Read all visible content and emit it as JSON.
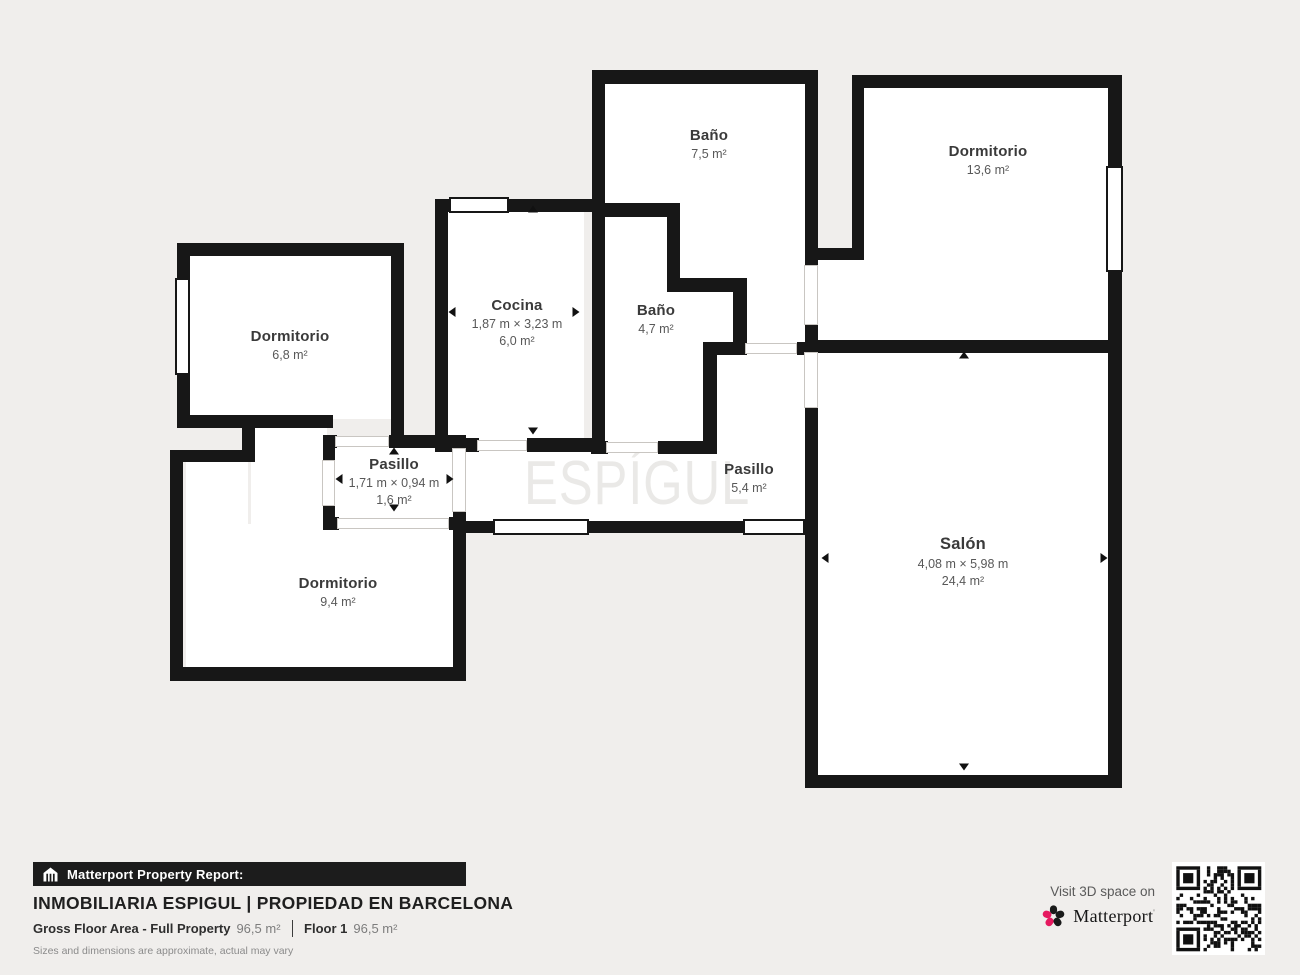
{
  "watermark": {
    "text": "ESPÍGUL"
  },
  "plan": {
    "wall_color": "#171717",
    "floor_color": "#ffffff",
    "background": "#f0eeec",
    "fills": [
      [
        598,
        78,
        210,
        130
      ],
      [
        676,
        180,
        132,
        104
      ],
      [
        743,
        270,
        65,
        78
      ],
      [
        860,
        84,
        252,
        260
      ],
      [
        816,
        256,
        80,
        88
      ],
      [
        444,
        208,
        140,
        234
      ],
      [
        601,
        213,
        70,
        232
      ],
      [
        601,
        288,
        136,
        60
      ],
      [
        601,
        348,
        106,
        97
      ],
      [
        713,
        350,
        96,
        100
      ],
      [
        463,
        447,
        345,
        78
      ],
      [
        331,
        442,
        127,
        80
      ],
      [
        186,
        252,
        209,
        167
      ],
      [
        186,
        458,
        62,
        212
      ],
      [
        251,
        424,
        76,
        246
      ],
      [
        186,
        524,
        272,
        146
      ],
      [
        814,
        348,
        298,
        430
      ]
    ],
    "walls": [
      [
        592,
        70,
        226,
        14
      ],
      [
        805,
        70,
        13,
        197
      ],
      [
        805,
        325,
        13,
        28
      ],
      [
        805,
        407,
        13,
        381
      ],
      [
        852,
        75,
        270,
        13
      ],
      [
        852,
        75,
        12,
        185
      ],
      [
        818,
        248,
        46,
        12
      ],
      [
        1108,
        75,
        14,
        91
      ],
      [
        1108,
        272,
        14,
        81
      ],
      [
        818,
        340,
        304,
        13
      ],
      [
        1108,
        353,
        14,
        435
      ],
      [
        805,
        775,
        317,
        13
      ],
      [
        592,
        70,
        13,
        381
      ],
      [
        592,
        203,
        80,
        14
      ],
      [
        667,
        203,
        13,
        89
      ],
      [
        667,
        278,
        76,
        14
      ],
      [
        733,
        278,
        14,
        77
      ],
      [
        703,
        342,
        44,
        13
      ],
      [
        797,
        342,
        8,
        13
      ],
      [
        703,
        342,
        14,
        112
      ],
      [
        591,
        441,
        17,
        13
      ],
      [
        658,
        441,
        59,
        13
      ],
      [
        435,
        199,
        14,
        13
      ],
      [
        509,
        199,
        96,
        13
      ],
      [
        435,
        199,
        13,
        253
      ],
      [
        435,
        438,
        44,
        14
      ],
      [
        527,
        438,
        78,
        14
      ],
      [
        177,
        243,
        227,
        13
      ],
      [
        177,
        243,
        13,
        35
      ],
      [
        177,
        375,
        13,
        53
      ],
      [
        391,
        243,
        13,
        192
      ],
      [
        177,
        415,
        156,
        13
      ],
      [
        242,
        415,
        13,
        47
      ],
      [
        170,
        450,
        85,
        12
      ],
      [
        170,
        450,
        13,
        231
      ],
      [
        170,
        667,
        296,
        14
      ],
      [
        453,
        435,
        13,
        15
      ],
      [
        453,
        512,
        13,
        160
      ],
      [
        323,
        435,
        14,
        13
      ],
      [
        389,
        435,
        77,
        13
      ],
      [
        323,
        435,
        12,
        27
      ],
      [
        323,
        506,
        12,
        24
      ],
      [
        323,
        517,
        16,
        13
      ],
      [
        449,
        517,
        17,
        13
      ],
      [
        466,
        521,
        29,
        12
      ],
      [
        589,
        521,
        156,
        12
      ]
    ],
    "windows": [
      [
        175,
        278,
        15,
        97
      ],
      [
        449,
        197,
        60,
        16
      ],
      [
        1106,
        166,
        17,
        106
      ],
      [
        493,
        519,
        96,
        16
      ],
      [
        743,
        519,
        62,
        16
      ]
    ],
    "doors": [
      [
        477,
        440,
        50,
        11
      ],
      [
        606,
        442,
        52,
        11
      ],
      [
        745,
        343,
        52,
        11
      ],
      [
        804,
        265,
        14,
        60
      ],
      [
        804,
        352,
        14,
        56
      ],
      [
        335,
        436,
        54,
        11
      ],
      [
        322,
        460,
        13,
        46
      ],
      [
        452,
        448,
        14,
        64
      ],
      [
        337,
        518,
        112,
        11
      ]
    ],
    "arrows": [
      {
        "dir": "up",
        "x": 533,
        "y": 209
      },
      {
        "dir": "down",
        "x": 533,
        "y": 431
      },
      {
        "dir": "left",
        "x": 452,
        "y": 312
      },
      {
        "dir": "right",
        "x": 576,
        "y": 312
      },
      {
        "dir": "up",
        "x": 394,
        "y": 451
      },
      {
        "dir": "down",
        "x": 394,
        "y": 508
      },
      {
        "dir": "left",
        "x": 339,
        "y": 479
      },
      {
        "dir": "right",
        "x": 450,
        "y": 479
      },
      {
        "dir": "up",
        "x": 964,
        "y": 355
      },
      {
        "dir": "down",
        "x": 964,
        "y": 767
      },
      {
        "dir": "left",
        "x": 825,
        "y": 558
      },
      {
        "dir": "right",
        "x": 1104,
        "y": 558
      }
    ]
  },
  "rooms": [
    {
      "id": "bano-75",
      "name": "Baño",
      "area": "7,5 m²",
      "x": 709,
      "y": 127
    },
    {
      "id": "dormitorio-136",
      "name": "Dormitorio",
      "area": "13,6 m²",
      "x": 988,
      "y": 143
    },
    {
      "id": "dormitorio-68",
      "name": "Dormitorio",
      "area": "6,8 m²",
      "x": 290,
      "y": 328
    },
    {
      "id": "cocina",
      "name": "Cocina",
      "dims": "1,87 m × 3,23 m",
      "area": "6,0 m²",
      "x": 517,
      "y": 297
    },
    {
      "id": "bano-47",
      "name": "Baño",
      "area": "4,7 m²",
      "x": 656,
      "y": 302
    },
    {
      "id": "pasillo-16",
      "name": "Pasillo",
      "dims": "1,71 m × 0,94 m",
      "area": "1,6 m²",
      "x": 394,
      "y": 456
    },
    {
      "id": "pasillo-54",
      "name": "Pasillo",
      "area": "5,4 m²",
      "x": 749,
      "y": 461
    },
    {
      "id": "dormitorio-94",
      "name": "Dormitorio",
      "area": "9,4 m²",
      "x": 338,
      "y": 575
    },
    {
      "id": "salon",
      "name": "Salón",
      "dims": "4,08 m × 5,98 m",
      "area": "24,4 m²",
      "x": 963,
      "y": 535,
      "big": true
    }
  ],
  "footer": {
    "report_label": "Matterport Property Report:",
    "title": "INMOBILIARIA ESPIGUL | PROPIEDAD EN BARCELONA",
    "gfa_label": "Gross Floor Area - Full Property",
    "gfa_value": "96,5 m²",
    "floor_label": "Floor 1",
    "floor_value": "96,5 m²",
    "disclaimer": "Sizes and dimensions are approximate, actual may vary",
    "visit_text": "Visit 3D space on",
    "brand": "Matterport"
  }
}
